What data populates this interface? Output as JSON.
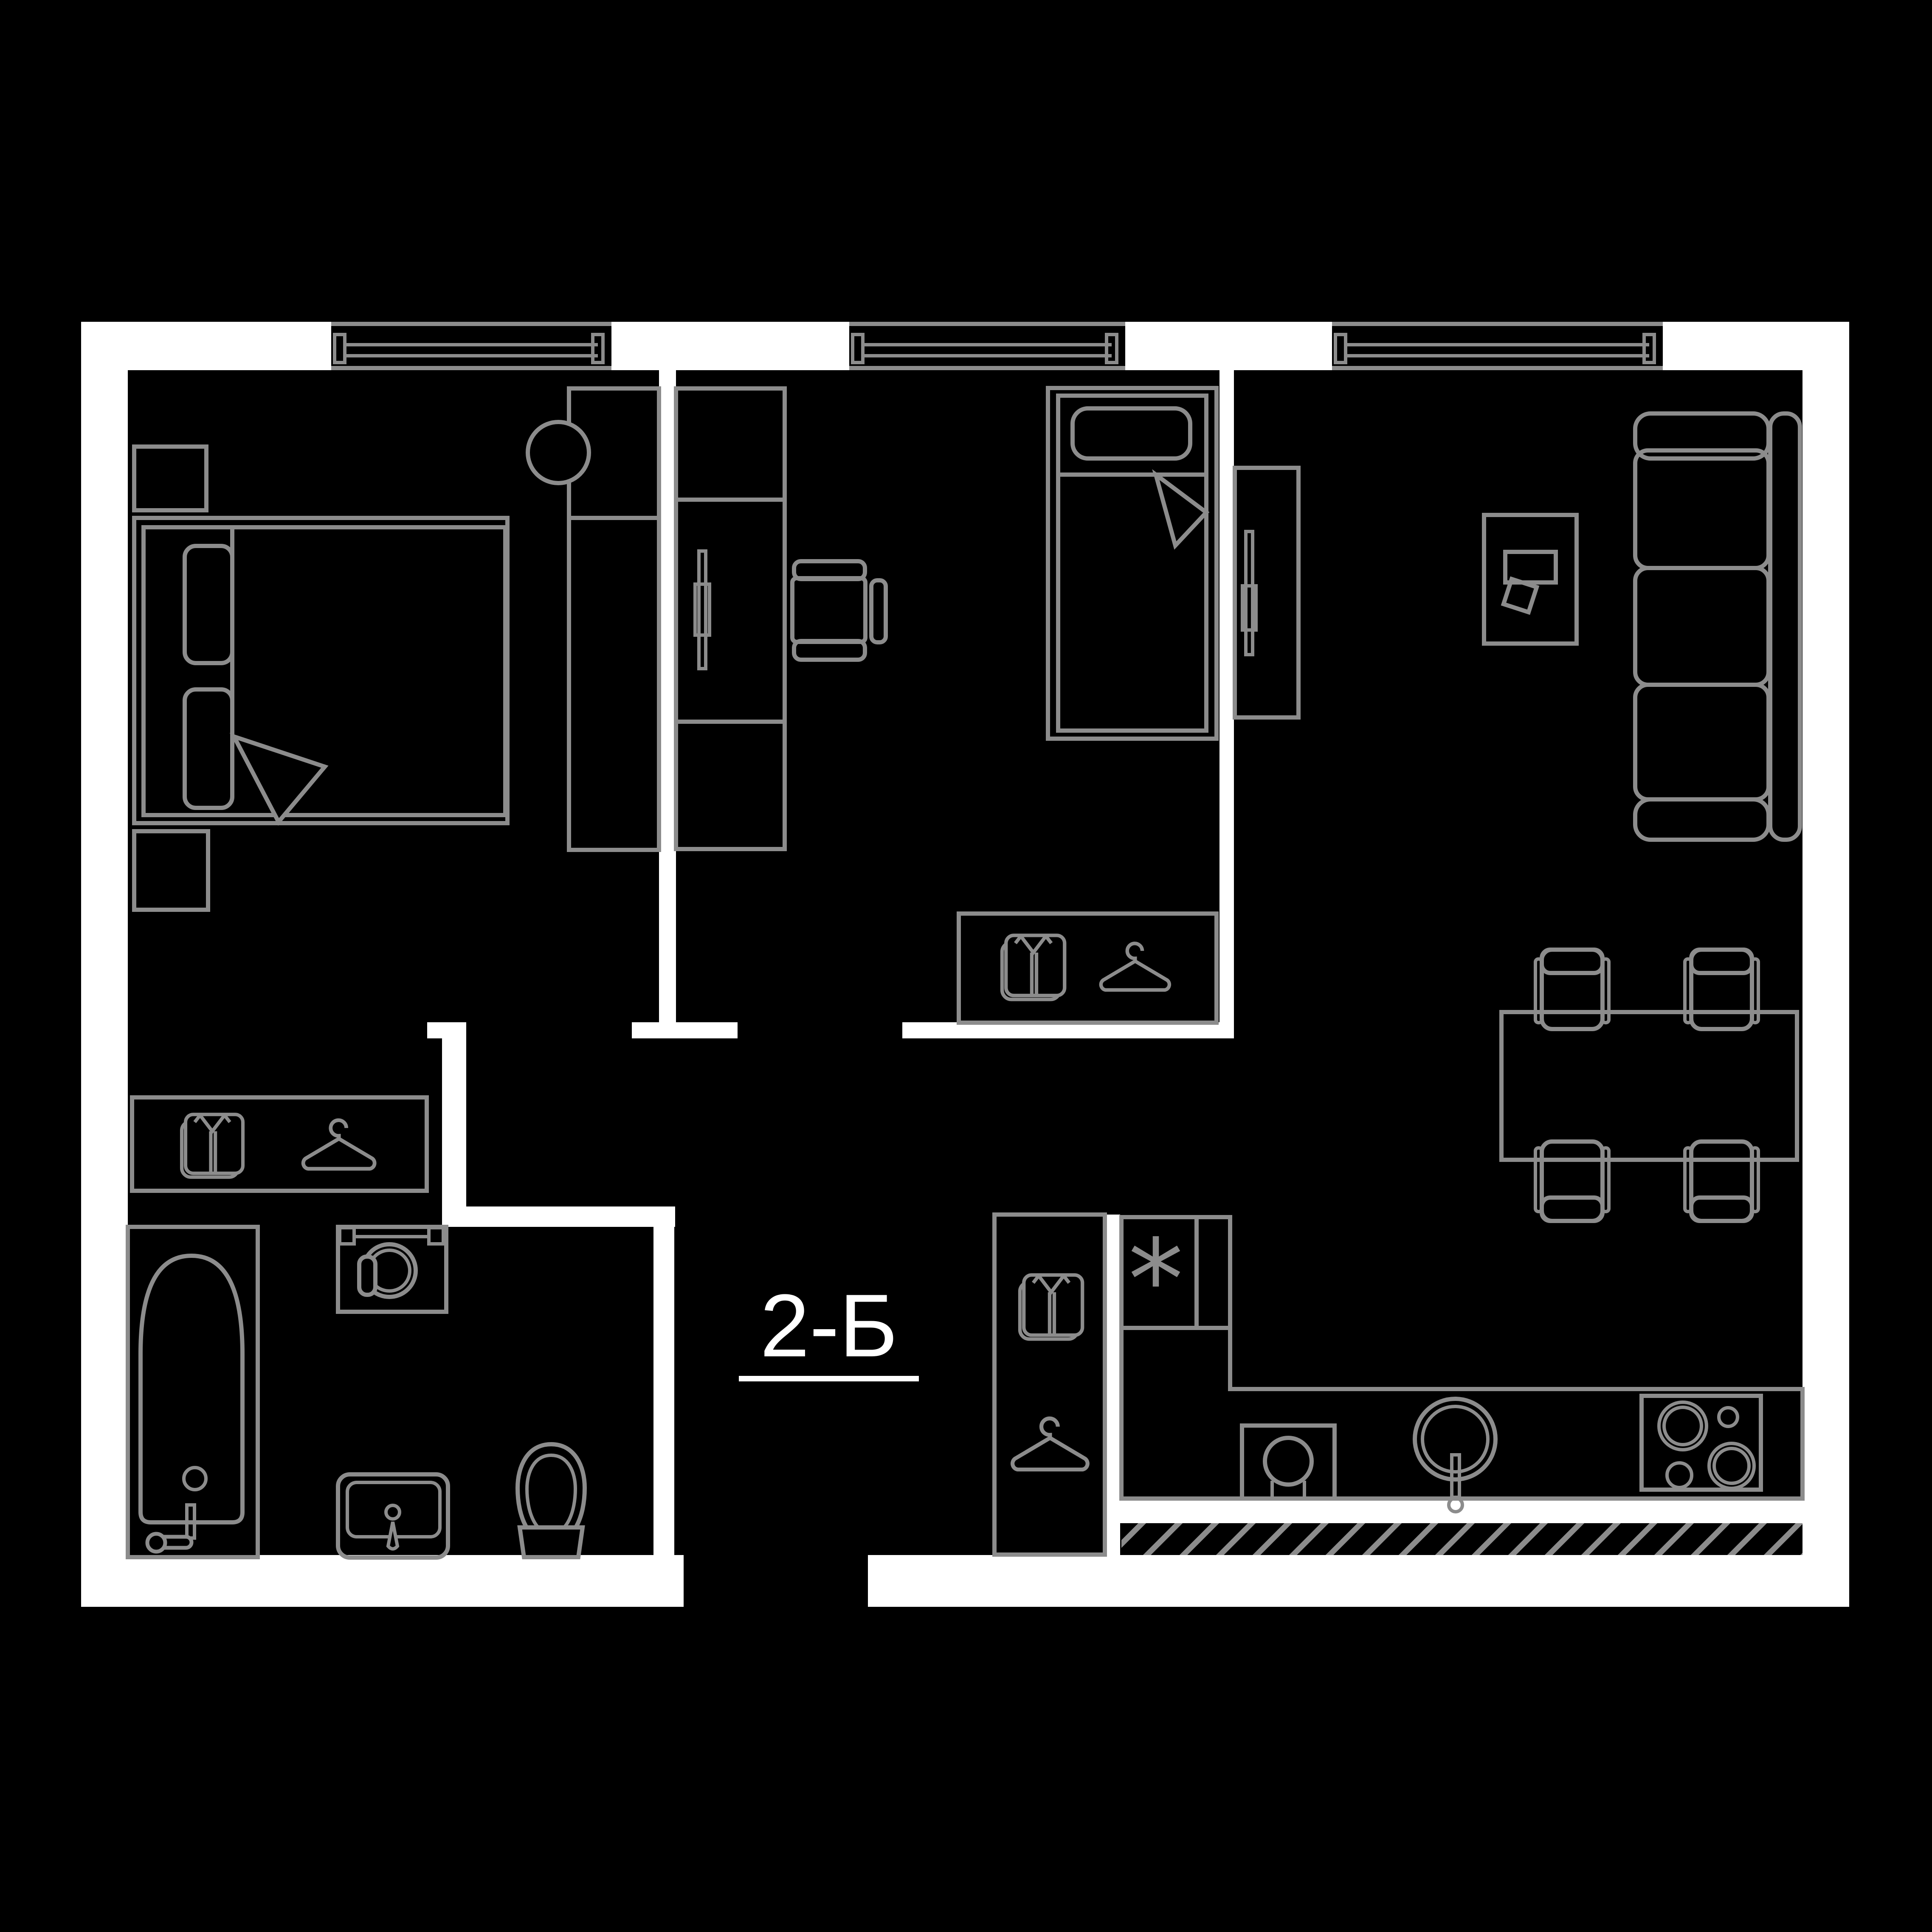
{
  "plan": {
    "unit_label": "2-Б",
    "kitchen": {
      "freezer_symbol": "*"
    }
  },
  "colors": {
    "background": "#000000",
    "wall": "#ffffff",
    "line": "#8c8c8c",
    "text": "#ffffff"
  },
  "icons": {
    "shirt": "folded-shirt wardrobe marker",
    "hanger": "clothes-hanger wardrobe marker",
    "freezer": "*"
  }
}
